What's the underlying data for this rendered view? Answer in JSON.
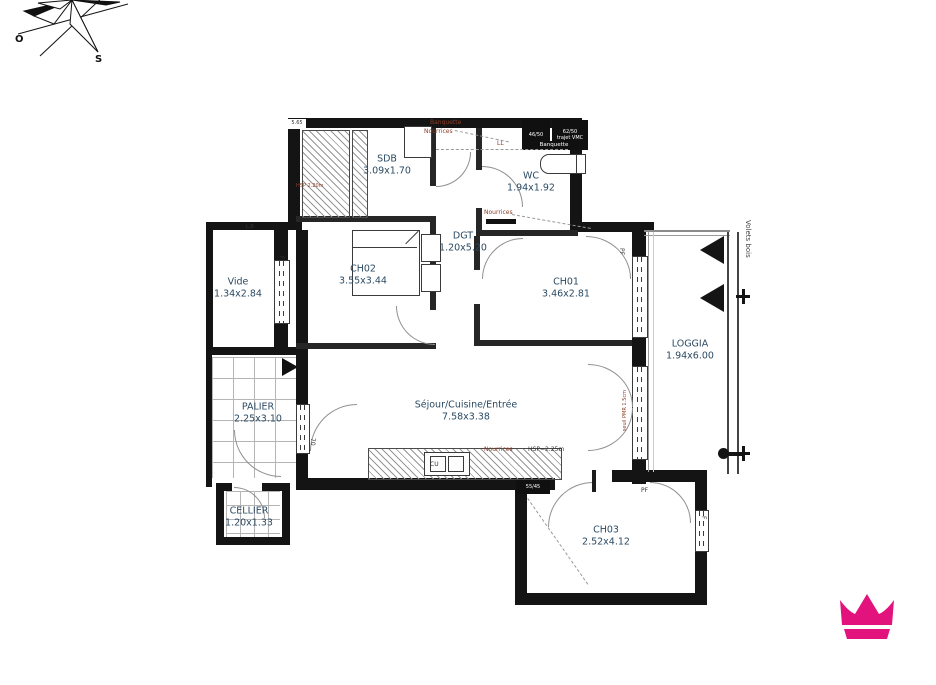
{
  "page": {
    "background": "#ffffff"
  },
  "brand": {
    "crown_color": "#e2137c"
  },
  "compass": {
    "west_label": "O",
    "south_label": "S"
  },
  "rooms": [
    {
      "id": "sdb",
      "name": "SDB",
      "dims": "3.09x1.70"
    },
    {
      "id": "wc",
      "name": "WC",
      "dims": "1.94x1.92"
    },
    {
      "id": "dgt",
      "name": "DGT",
      "dims": "1.20x5.20"
    },
    {
      "id": "ch02",
      "name": "CH02",
      "dims": "3.55x3.44"
    },
    {
      "id": "ch01",
      "name": "CH01",
      "dims": "3.46x2.81"
    },
    {
      "id": "vide",
      "name": "Vide",
      "dims": "1.34x2.84"
    },
    {
      "id": "loggia",
      "name": "LOGGIA",
      "dims": "1.94x6.00"
    },
    {
      "id": "palier",
      "name": "PALIER",
      "dims": "2.25x3.10"
    },
    {
      "id": "sejour",
      "name": "Séjour/Cuisine/Entrée",
      "dims": "7.58x3.38"
    },
    {
      "id": "cellier",
      "name": "CELLIER",
      "dims": "1.20x1.33"
    },
    {
      "id": "ch03",
      "name": "CH03",
      "dims": "2.52x4.12"
    }
  ],
  "annotations": {
    "banquette_top": "Banquette",
    "nourrices_top": "Nourrices",
    "ll": "LL",
    "duct_46": "46/50",
    "duct_62": "62/50",
    "trajet_vmc": "trajet VMC",
    "banquette_wc": "Banquette",
    "nourrices_dgt": "Nourrices",
    "nourrices_kitchen": "Nourrices",
    "hsp_kitchen": "HSP=2.25m",
    "hsp_sdb": "HSP 2.20m",
    "duct_55": "55/45",
    "kitchen_unit": "CU",
    "pf_ch01": "PF",
    "pf_ch03": "PF",
    "f_vide": "F",
    "f_ch03": "F",
    "door_width": "70",
    "shaft_note": "5.65",
    "lb_note": "L.B",
    "volets": "Volets bois",
    "seuil_note": "seuil PMR 1.5cm"
  }
}
